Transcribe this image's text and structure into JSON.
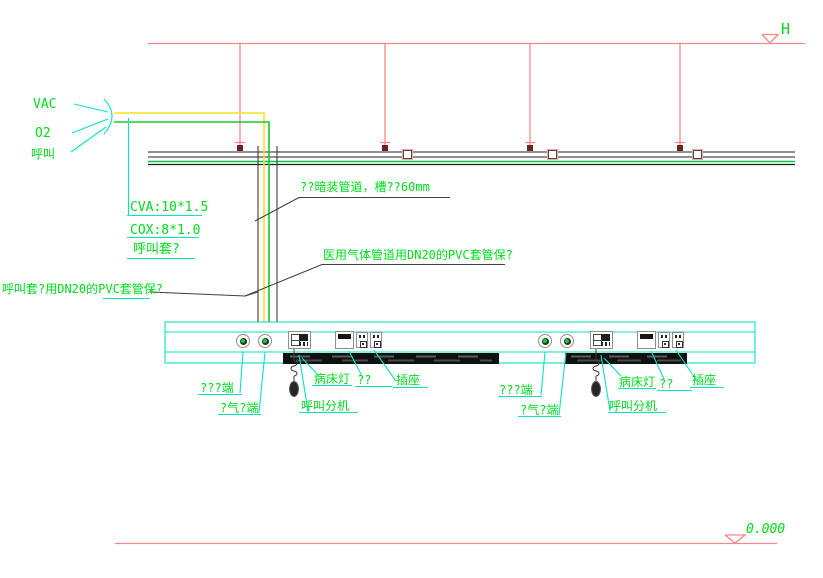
{
  "drawing": {
    "gas_labels": {
      "vac": "VAC",
      "o2": "O2",
      "call": "呼叫"
    },
    "spec_notes": {
      "cva": "CVA:10*1.5",
      "cox": "COX:8*1.0",
      "call_sleeve": "呼叫套?"
    },
    "notes": {
      "concealed": "??暗装管道，槽??60mm",
      "medical_gas": "医用气体管道用DN20的PVC套管保?",
      "call_sleeve_dn20": "呼叫套?用DN20的PVC套管保?"
    },
    "levels": {
      "ceiling": "H",
      "floor": "0.000"
    },
    "bedhead_labels": {
      "terminal_a": "???端",
      "terminal_b": "?气?端",
      "call_extension": "呼叫分机",
      "bed_light": "病床灯",
      "unknown": "??",
      "socket": "插座"
    },
    "colors": {
      "annotation_green": "#00dc1e",
      "leader_cyan": "#0ae2c3",
      "level_red": "#f0898b",
      "pipe_yellow": "#f1e41f",
      "pipe_green": "#12cd2e"
    }
  }
}
